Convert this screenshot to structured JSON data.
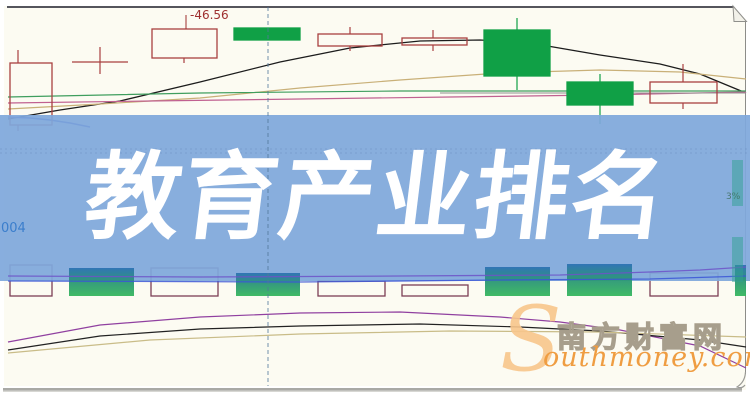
{
  "page": {
    "banner": {
      "title": "教育产业排名",
      "bg_color": "#7fa8dc",
      "text_color": "#ffffff"
    },
    "price_marker_label": "-46.56",
    "axis_label_left": "004",
    "right_pct_label": "3%",
    "watermark": {
      "s_glyph": "S",
      "cn_text": "南方财富网",
      "en_text": "outhmoney.com",
      "orange": "#ef9d42",
      "pale_orange": "#f8c68c",
      "outline_gray": "#a79e8c"
    }
  },
  "chart_data": {
    "type": "candlestick",
    "title": "教育产业排名",
    "legend_position": "none",
    "grid": false,
    "colors": {
      "candle_up_outline": "#a84040",
      "candle_down_fill": "#10a046",
      "volume_hollow_outline": "#7c3f55",
      "gradient_top": "#2d72b4",
      "gradient_mid": "#2a9478",
      "gradient_bottom": "#36b75e",
      "banner": "#7fa8dc",
      "dashed_line": "#50789b",
      "teal_bar": "#2f9f92"
    },
    "price_marker": {
      "text": "-46.56",
      "leader_x": 186,
      "leader_y1": 15,
      "leader_y2": 29
    },
    "doji_cross": {
      "cx": 100,
      "y": 62,
      "x1": 72,
      "x2": 128,
      "y1": 47,
      "y2": 74
    },
    "candles": [
      {
        "x": 10,
        "y": 63,
        "w": 42,
        "h": 62,
        "dir": "up",
        "wicks": [
          [
            18,
            50,
            63
          ],
          [
            18,
            125,
            131
          ]
        ]
      },
      {
        "x": 152,
        "y": 29,
        "w": 65,
        "h": 29,
        "dir": "up",
        "wicks": [
          [
            184,
            58,
            63
          ]
        ]
      },
      {
        "x": 234,
        "y": 28,
        "w": 66,
        "h": 12,
        "dir": "down",
        "wicks": []
      },
      {
        "x": 318,
        "y": 34,
        "w": 64,
        "h": 12,
        "dir": "up",
        "wicks": [
          [
            350,
            27,
            34
          ],
          [
            350,
            46,
            51
          ]
        ]
      },
      {
        "x": 402,
        "y": 38,
        "w": 65,
        "h": 7,
        "dir": "up",
        "wicks": [
          [
            433,
            30,
            38
          ],
          [
            433,
            45,
            51
          ]
        ]
      },
      {
        "x": 484,
        "y": 30,
        "w": 66,
        "h": 46,
        "dir": "down",
        "wicks": [
          [
            517,
            18,
            30
          ],
          [
            517,
            76,
            90
          ]
        ]
      },
      {
        "x": 567,
        "y": 82,
        "w": 66,
        "h": 23,
        "dir": "down",
        "wicks": [
          [
            600,
            74,
            82
          ],
          [
            600,
            105,
            124
          ]
        ]
      },
      {
        "x": 650,
        "y": 82,
        "w": 67,
        "h": 21,
        "dir": "up",
        "wicks": [
          [
            683,
            64,
            82
          ],
          [
            683,
            103,
            109
          ]
        ]
      }
    ],
    "ma_lines_upper": [
      {
        "name": "ma-black",
        "color": "#1c1c1c",
        "w": 1.3,
        "points": [
          [
            8,
            119
          ],
          [
            60,
            110
          ],
          [
            120,
            101
          ],
          [
            200,
            82
          ],
          [
            280,
            62
          ],
          [
            350,
            48
          ],
          [
            420,
            41
          ],
          [
            480,
            40
          ],
          [
            530,
            43
          ],
          [
            600,
            55
          ],
          [
            660,
            64
          ],
          [
            700,
            74
          ],
          [
            746,
            93
          ]
        ]
      },
      {
        "name": "ma-tan",
        "color": "#c9b078",
        "w": 1.2,
        "points": [
          [
            8,
            109
          ],
          [
            100,
            104
          ],
          [
            200,
            98
          ],
          [
            300,
            88
          ],
          [
            400,
            80
          ],
          [
            500,
            73
          ],
          [
            600,
            70
          ],
          [
            680,
            72
          ],
          [
            746,
            79
          ]
        ]
      },
      {
        "name": "ma-pink",
        "color": "#c06090",
        "w": 1.2,
        "points": [
          [
            8,
            103
          ],
          [
            150,
            101
          ],
          [
            300,
            99
          ],
          [
            450,
            97
          ],
          [
            600,
            95
          ],
          [
            746,
            92
          ]
        ]
      },
      {
        "name": "ma-green",
        "color": "#3f9e5e",
        "w": 1.2,
        "points": [
          [
            8,
            97
          ],
          [
            200,
            93
          ],
          [
            400,
            91
          ],
          [
            746,
            91
          ]
        ]
      },
      {
        "name": "ma-gray",
        "color": "#909090",
        "w": 1.1,
        "points": [
          [
            440,
            93
          ],
          [
            746,
            93
          ]
        ]
      },
      {
        "name": "ma-blue",
        "color": "#2a3cc0",
        "w": 1.6,
        "points": [
          [
            8,
            117
          ],
          [
            30,
            118
          ],
          [
            50,
            120
          ],
          [
            70,
            123
          ],
          [
            90,
            127
          ]
        ]
      }
    ],
    "volume_bars_hollow": [
      {
        "x": 10,
        "y": 265,
        "w": 42,
        "h": 31
      },
      {
        "x": 151,
        "y": 268,
        "w": 67,
        "h": 28
      },
      {
        "x": 318,
        "y": 281,
        "w": 67,
        "h": 15
      },
      {
        "x": 402,
        "y": 285,
        "w": 66,
        "h": 11
      },
      {
        "x": 650,
        "y": 273,
        "w": 68,
        "h": 23
      }
    ],
    "volume_bars_solid": [
      {
        "x": 69,
        "y": 268,
        "w": 65,
        "h": 28
      },
      {
        "x": 236,
        "y": 273,
        "w": 64,
        "h": 23
      },
      {
        "x": 485,
        "y": 267,
        "w": 65,
        "h": 29
      },
      {
        "x": 567,
        "y": 264,
        "w": 65,
        "h": 32
      },
      {
        "x": 735,
        "y": 265,
        "w": 11,
        "h": 31
      }
    ],
    "volume_ma_lines": [
      {
        "name": "vol-ma-purple",
        "color": "#6d52c8",
        "w": 1.3,
        "points": [
          [
            8,
            276
          ],
          [
            200,
            277
          ],
          [
            400,
            276
          ],
          [
            560,
            275
          ],
          [
            650,
            272
          ],
          [
            700,
            270
          ],
          [
            746,
            267
          ]
        ]
      },
      {
        "name": "vol-ma-blue",
        "color": "#3b55d6",
        "w": 1.3,
        "points": [
          [
            8,
            281
          ],
          [
            300,
            282
          ],
          [
            500,
            280
          ],
          [
            650,
            279
          ],
          [
            746,
            276
          ]
        ]
      }
    ],
    "lower_curves": [
      {
        "name": "curve-purple",
        "color": "#9040a0",
        "w": 1.2,
        "points": [
          [
            8,
            342
          ],
          [
            100,
            325
          ],
          [
            200,
            317
          ],
          [
            300,
            313
          ],
          [
            400,
            312
          ],
          [
            500,
            317
          ],
          [
            560,
            322
          ],
          [
            620,
            330
          ],
          [
            700,
            346
          ],
          [
            746,
            368
          ]
        ]
      },
      {
        "name": "curve-black",
        "color": "#222222",
        "w": 1.2,
        "points": [
          [
            8,
            350
          ],
          [
            100,
            336
          ],
          [
            200,
            329
          ],
          [
            300,
            326
          ],
          [
            420,
            324
          ],
          [
            520,
            327
          ],
          [
            600,
            331
          ],
          [
            700,
            340
          ],
          [
            746,
            347
          ]
        ]
      },
      {
        "name": "curve-tan",
        "color": "#c9bc88",
        "w": 1.2,
        "points": [
          [
            8,
            353
          ],
          [
            150,
            340
          ],
          [
            300,
            334
          ],
          [
            450,
            331
          ],
          [
            600,
            332
          ],
          [
            746,
            337
          ]
        ]
      }
    ],
    "dashed_vline_x": 268,
    "right_edge_bars": [
      {
        "x": 732,
        "y": 160,
        "w": 11,
        "h": 46
      },
      {
        "x": 732,
        "y": 237,
        "w": 11,
        "h": 45
      }
    ]
  }
}
